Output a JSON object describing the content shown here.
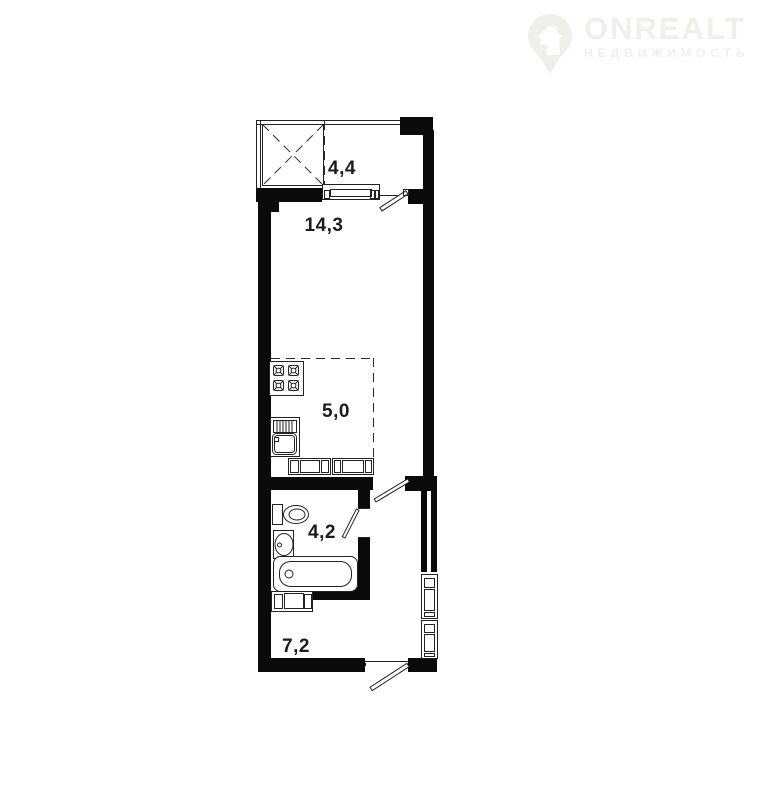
{
  "logo": {
    "brand": "ONREALT",
    "subtitle": "НЕДВИЖИМОСТЬ"
  },
  "plan": {
    "areas": {
      "balcony": "4,4",
      "living_room": "14,3",
      "kitchen": "5,0",
      "bathroom": "4,2",
      "hallway": "7,2"
    }
  },
  "colors": {
    "walls": "#0a0a0a",
    "thin_lines": "#222222",
    "labels": "#1c1c1c",
    "logo": "#f1efeb",
    "background": "#ffffff"
  }
}
